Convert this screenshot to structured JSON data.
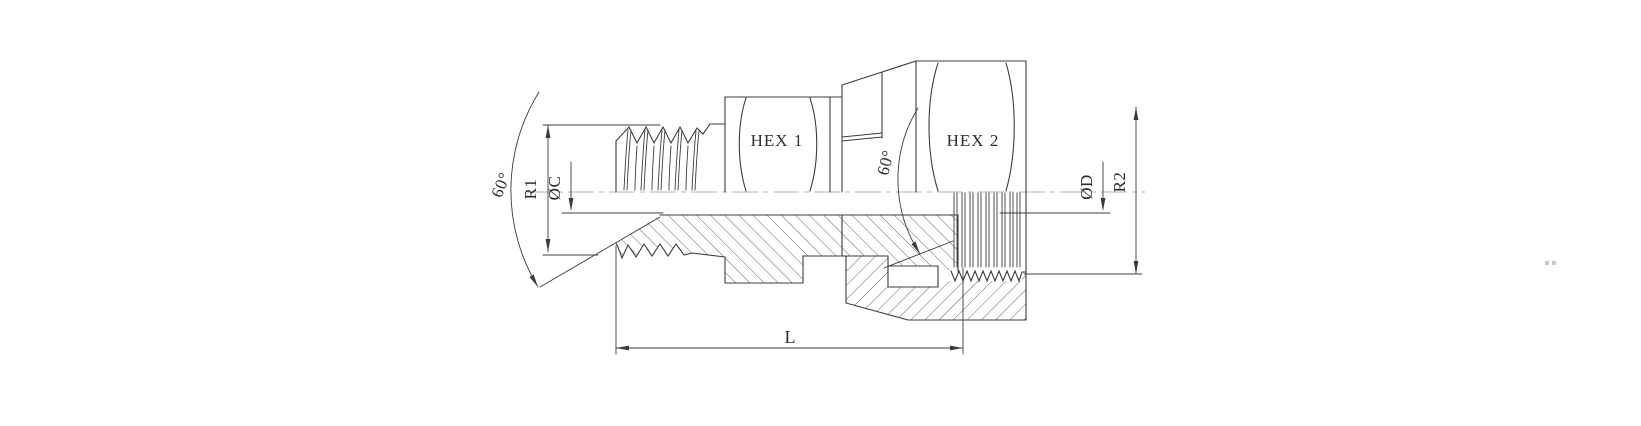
{
  "drawing": {
    "labels": {
      "hex1": "HEX 1",
      "hex2": "HEX 2",
      "r1": "R1",
      "dia_c": "ØC",
      "dia_d": "ØD",
      "r2": "R2",
      "length": "L",
      "angle_left": "60°",
      "angle_right": "60°"
    },
    "colors": {
      "line": "#3c3c3c",
      "hatch": "#555555",
      "centerline": "#b5b5b5",
      "text": "#2e2e2e",
      "background": "#ffffff"
    }
  }
}
